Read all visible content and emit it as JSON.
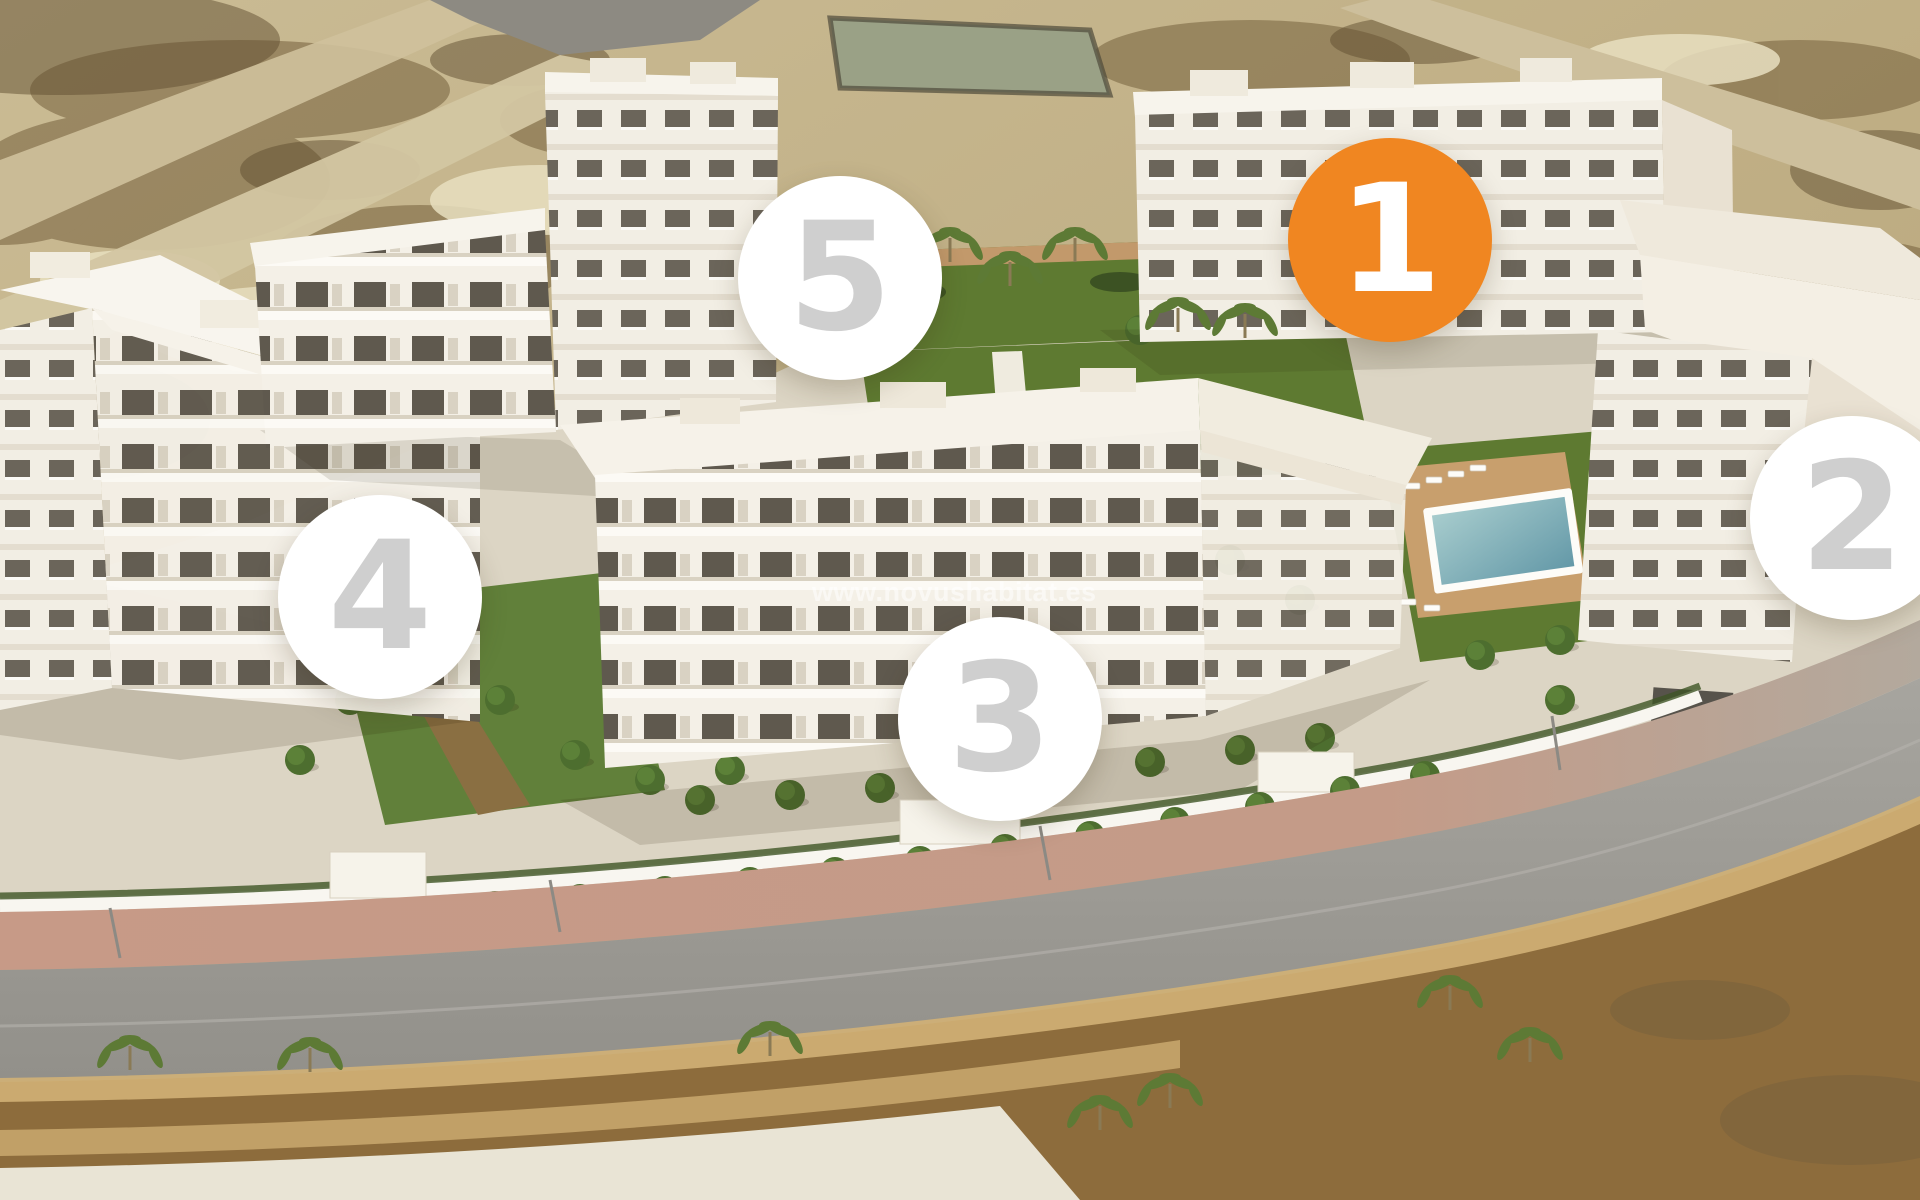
{
  "watermark": {
    "text": "www.novushabitat.es"
  },
  "badges": [
    {
      "number": "1",
      "highlighted": true
    },
    {
      "number": "2",
      "highlighted": false
    },
    {
      "number": "3",
      "highlighted": false
    },
    {
      "number": "4",
      "highlighted": false
    },
    {
      "number": "5",
      "highlighted": false
    }
  ],
  "colors": {
    "accent": "#F08621",
    "badge_bg": "#FFFFFF",
    "badge_number": "#CFCFCF",
    "badge_number_highlighted": "#FFFFFF"
  }
}
